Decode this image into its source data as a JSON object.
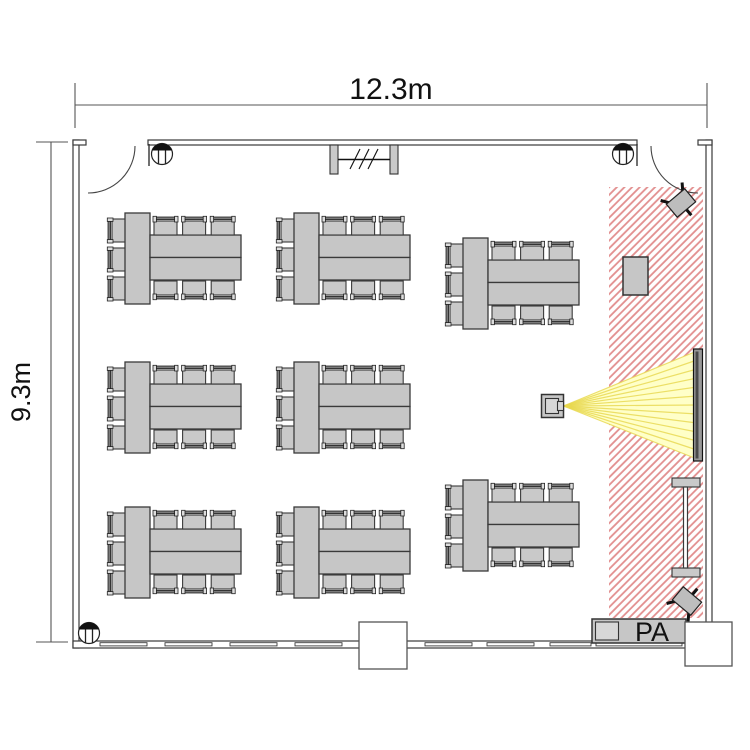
{
  "dimensions": {
    "width_label": "12.3m",
    "height_label": "9.3m"
  },
  "stage": {
    "pa_label": "PA"
  },
  "furniture": {
    "table_groups": 8,
    "chairs_per_group": 9,
    "layout_note": "3 columns of island tables facing a hatched stage strip on the right"
  },
  "equipment": {
    "icons": [
      "projector-icon",
      "screen-icon",
      "speaker-icon",
      "pa-table-icon",
      "door-swing-icon",
      "column-icon",
      "partition-icon"
    ]
  },
  "colors": {
    "hatch_red": "#e28f8f",
    "beam_fill": "#ffffc8",
    "beam_ray": "#e8d84e",
    "furniture_gray": "#c6c6c6",
    "outline": "#3a3a3a",
    "screen_gray": "#999999"
  }
}
